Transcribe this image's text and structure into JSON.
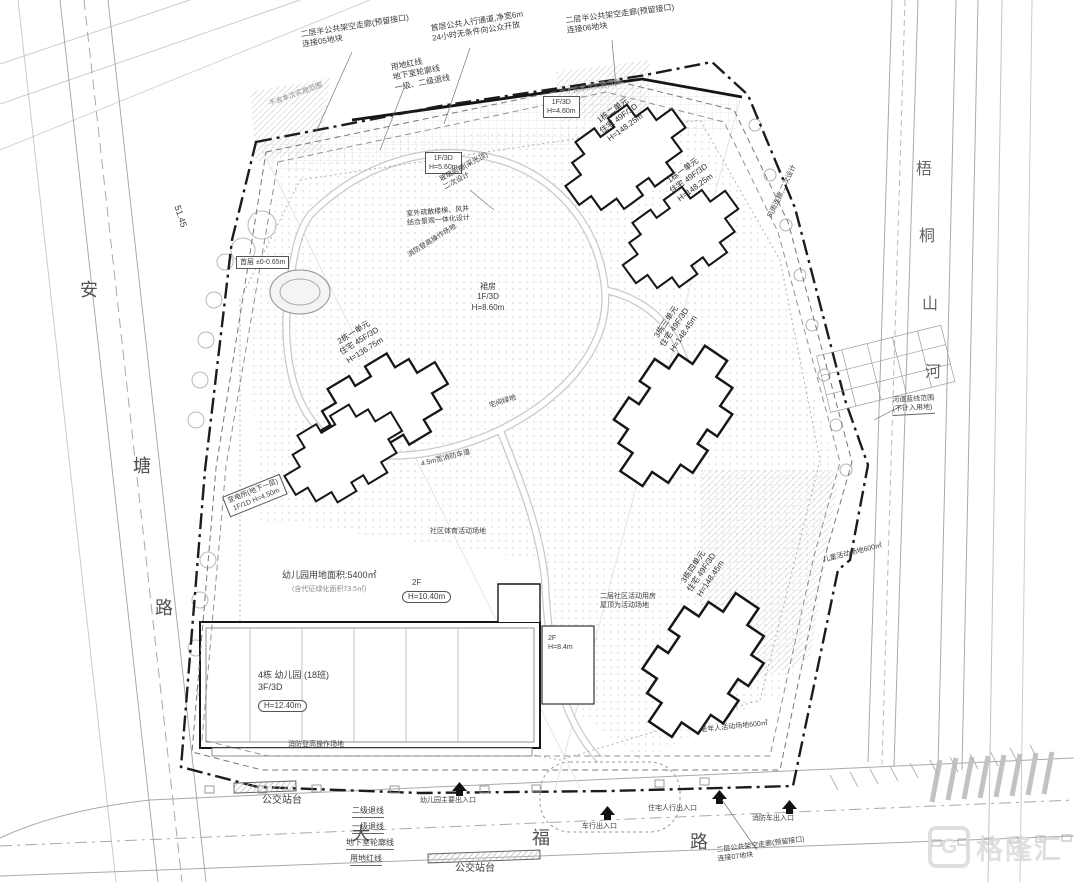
{
  "roads": {
    "left": [
      "安",
      "塘",
      "路"
    ],
    "bottom": [
      "大",
      "福",
      "路"
    ],
    "river": [
      "梧",
      "桐",
      "山",
      "河"
    ]
  },
  "buildings": {
    "b1u2": "1栋二单元\n住宅 49F/3D\nH=148.25m",
    "b1u1": "1栋一单元\n住宅 49F/3D\nH=148.25m",
    "b2u1": "2栋一单元\n住宅 45F/3D\nH=136.75m",
    "b3u3": "3栋三单元\n住宅 49F/3D\nH=148.45m",
    "b3u4": "3栋四单元\n住宅 49F/3D\nH=148.45m",
    "podium": "裙房\n1F/3D\nH=8.60m",
    "kindergarten": "4栋 幼儿园 (18班)\n3F/3D",
    "kindergarten_h": "H=12.40m",
    "annex_2f": "2F",
    "annex_2f_h": "H=10.40m",
    "block_2f": "2F\nH=8.4m",
    "community": "二层社区活动用房\n屋顶为活动场地",
    "substation": "变电所(地下一层)\n1F/1D H=4.50m",
    "box_a": "1F/3D\nH=4.60m",
    "box_b": "1F/3D\nH=5.60m",
    "first_floor": "首层 ±0-0.65m"
  },
  "notes": {
    "corridor05": "二层半公共架空走廊(预留接口)\n连接05地块",
    "redlines": "用地红线\n地下室轮廓线\n一级、二级退线",
    "walkway": "首层公共人行通道,净宽6m\n24小时无条件向公众开放",
    "corridor06": "二层半公共架空走廊(预留接口)\n连接06地块",
    "corridor07": "二层公共架空走廊(预留接口)\n连接07地块",
    "excluded1": "不含本次实施范围",
    "excluded2": "不含本次实施范围",
    "canopy": "玻璃雨棚(采光顶)\n二次设计",
    "stairs": "室外疏散楼梯、风井\n结合景观一体化设计",
    "fire_pad1": "消防登高操作场地",
    "fire_pad2": "消防登高操作场地",
    "rain_corridor": "风雨连廊,二次设计",
    "green": "宅间绿地",
    "fire_lane": "4.5m宽消防车道",
    "sports": "社区体育活动场地",
    "kg_area": "幼儿园用地面积:5400㎡",
    "kg_area_sub": "(含代征绿化面积73.5㎡)",
    "children": "儿童活动场地600㎡",
    "elderly": "老年人活动场地600㎡",
    "elev": "51.45",
    "river_blue": "河道蓝线范围\n(不计入用地)"
  },
  "legend": {
    "l2": "二级退线",
    "l1": "一级退线",
    "lb": "地下室轮廓线",
    "lr": "用地红线"
  },
  "transit": {
    "bus1": "公交站台",
    "bus2": "公交站台"
  },
  "entrances": {
    "kg": "幼儿园主要出入口",
    "vehicle": "车行出入口",
    "ped": "住宅人行出入口",
    "fire": "消防车出入口"
  },
  "watermark": {
    "logo": "G",
    "brand": "格隆汇"
  }
}
